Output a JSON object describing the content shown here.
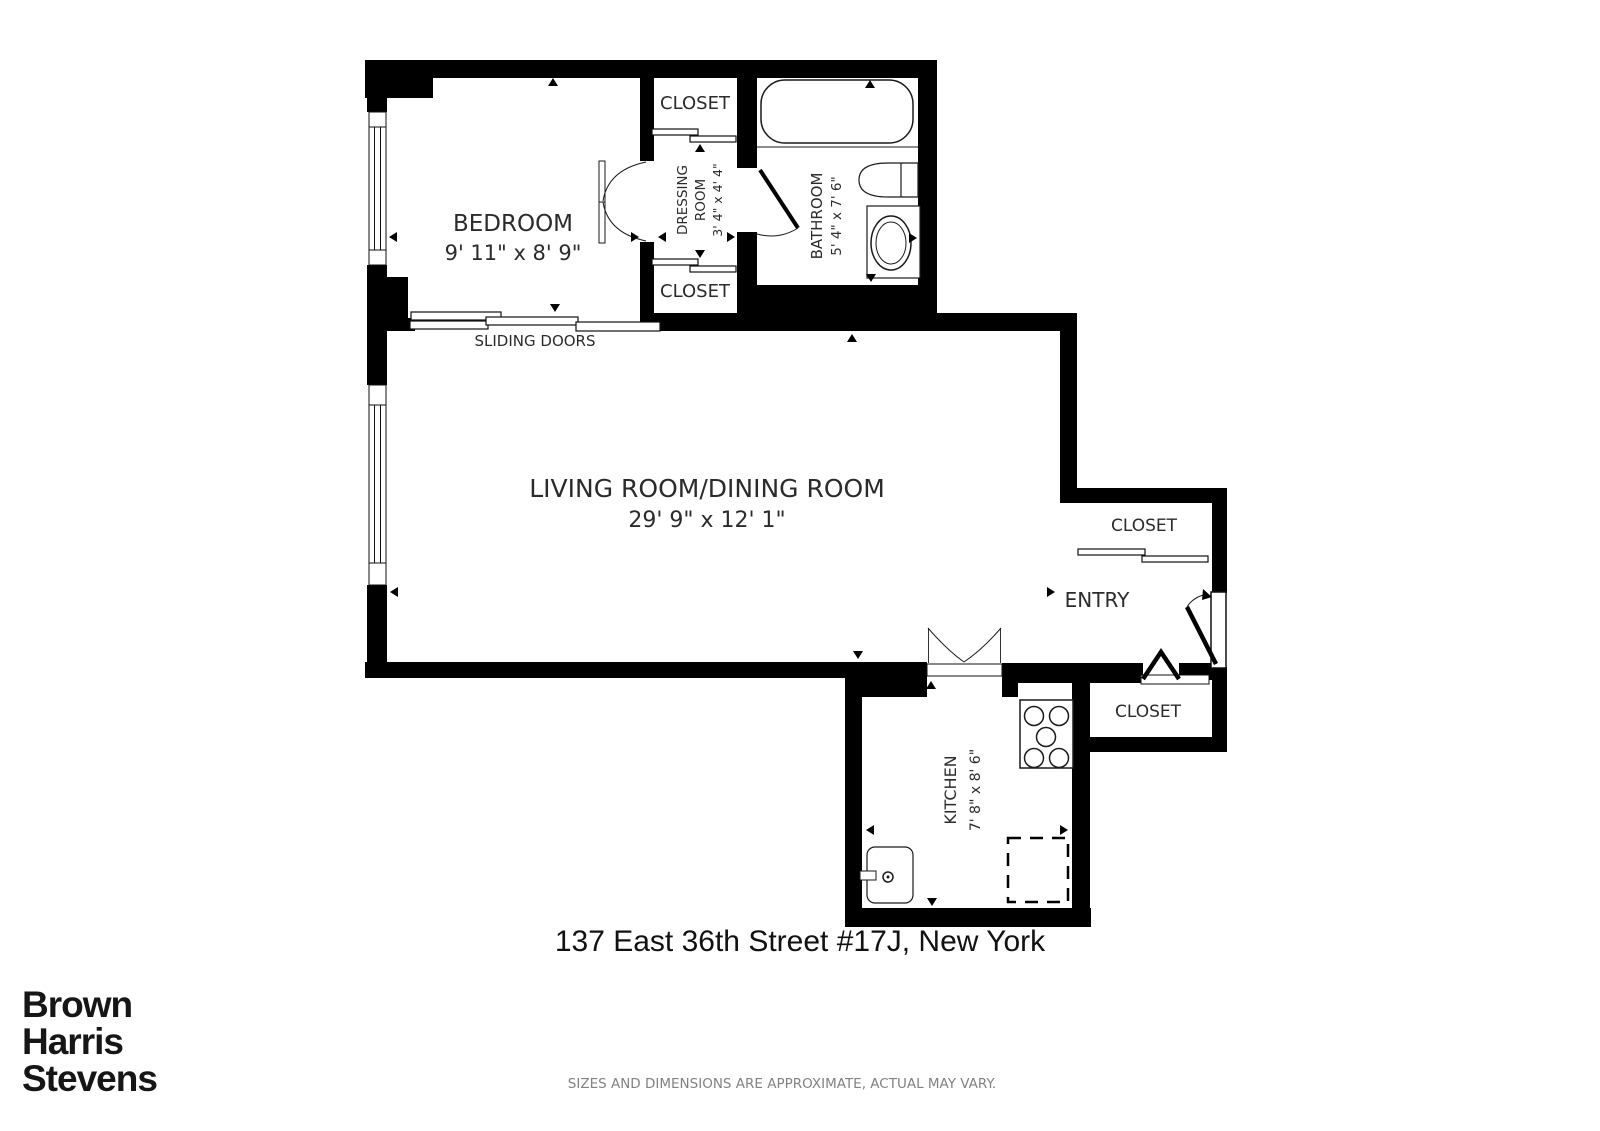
{
  "plan": {
    "rooms": {
      "bedroom": {
        "name": "BEDROOM",
        "dims": "9' 11\" x 8' 9\""
      },
      "living": {
        "name": "LIVING ROOM/DINING ROOM",
        "dims": "29' 9\" x 12' 1\""
      },
      "dressing": {
        "name_line1": "DRESSING",
        "name_line2": "ROOM",
        "dims": "3' 4\" x 4' 4\""
      },
      "bathroom": {
        "name": "BATHROOM",
        "dims": "5' 4\" x 7' 6\""
      },
      "kitchen": {
        "name": "KITCHEN",
        "dims": "7' 8\" x 8' 6\""
      },
      "entry": {
        "name": "ENTRY"
      },
      "closet_top": "CLOSET",
      "closet_bottom": "CLOSET",
      "closet_entry_upper": "CLOSET",
      "closet_entry_lower": "CLOSET",
      "sliding_doors_label": "SLIDING DOORS"
    },
    "colors": {
      "wall": "#000000",
      "line": "#1a1a1a",
      "label": "#2b2b2b"
    }
  },
  "address": "137 East 36th Street #17J, New York",
  "logo": {
    "line1": "Brown",
    "line2": "Harris",
    "line3": "Stevens"
  },
  "footer": "SIZES AND DIMENSIONS ARE APPROXIMATE, ACTUAL MAY VARY."
}
